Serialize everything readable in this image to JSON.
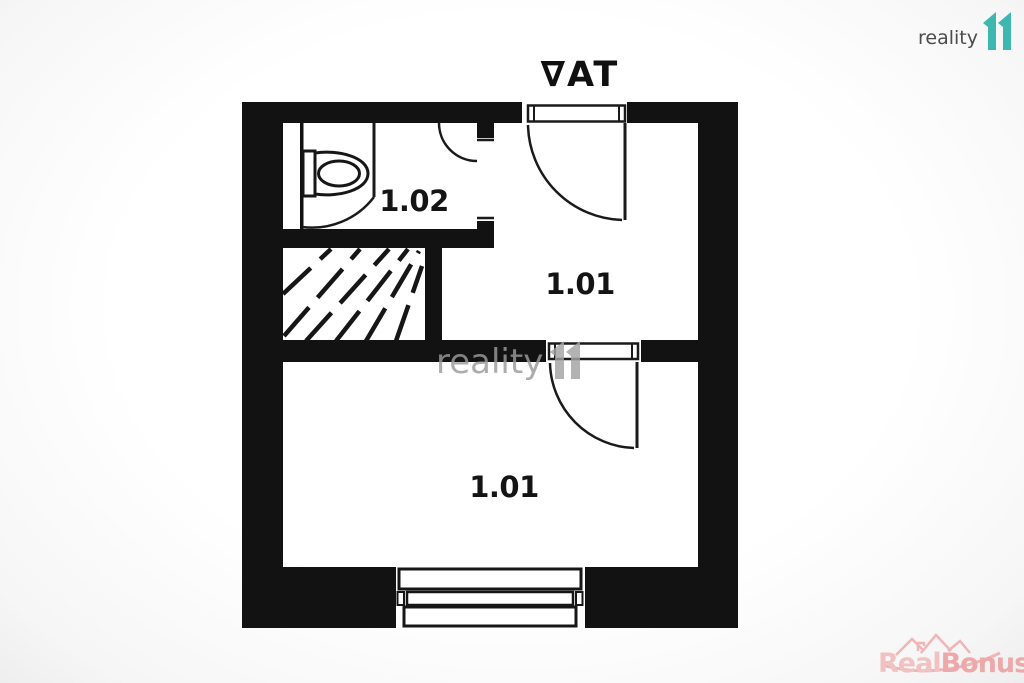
{
  "branding": {
    "logo_text": "reality",
    "logo_mark": "11",
    "logo_color": "#3eb7b1"
  },
  "watermarks": {
    "center_text": "reality",
    "corner": {
      "real": "Real",
      "bonus": "Bonus",
      "tld": ".cz"
    }
  },
  "floorplan": {
    "entrance_label": "∇AT",
    "rooms": [
      {
        "id": "wc",
        "label": "1.02"
      },
      {
        "id": "upper-room",
        "label": "1.01"
      },
      {
        "id": "main-room",
        "label": "1.01"
      }
    ]
  },
  "colors": {
    "wall": "#121212",
    "line": "#1a1a1a",
    "teal": "#3eb7b1",
    "logo_gray": "#4b4b4b",
    "watermark_gray": "#9b9b9b",
    "pink": "#eda9a9",
    "pink_light": "#f2c2c2"
  }
}
